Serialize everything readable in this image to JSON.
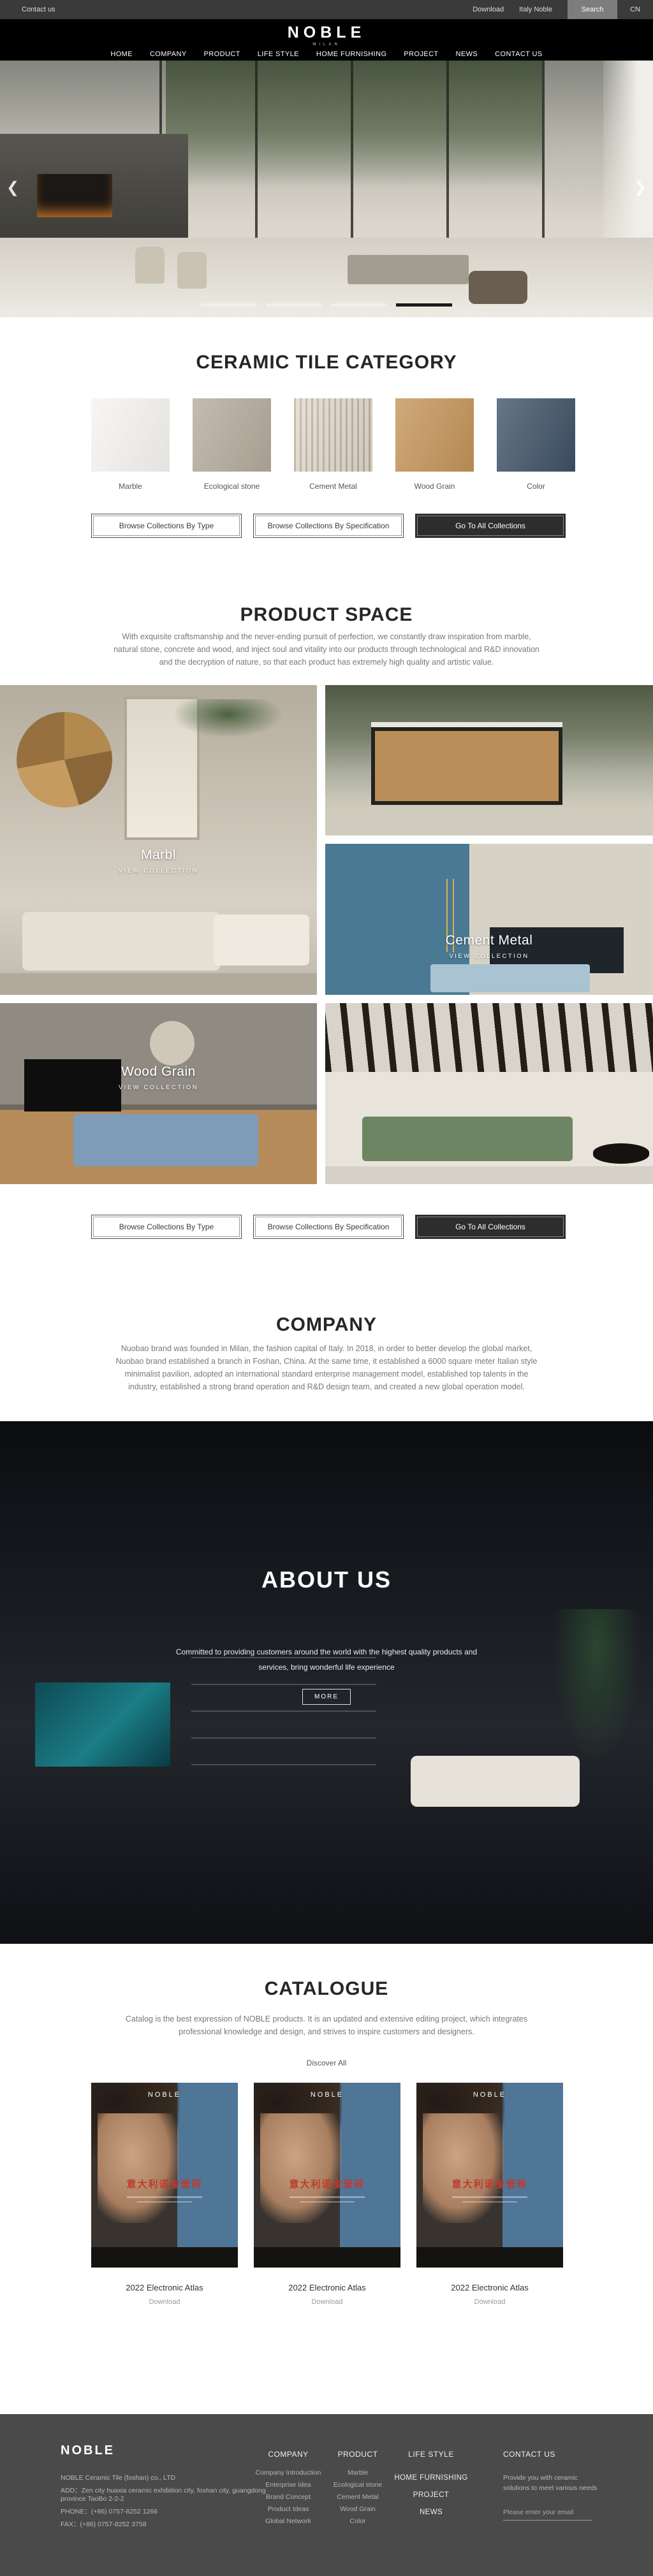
{
  "topbar": {
    "contact_us": "Contact us",
    "download": "Download",
    "italy_noble": "Italy Noble",
    "search": "Search",
    "language": "CN"
  },
  "header": {
    "logo": "NOBLE",
    "logo_subtitle": "MILAN",
    "nav": [
      "HOME",
      "COMPANY",
      "PRODUCT",
      "LIFE STYLE",
      "HOME FURNISHING",
      "PROJECT",
      "NEWS",
      "CONTACT US"
    ]
  },
  "hero": {
    "prev_arrow": "❮",
    "next_arrow": "❯",
    "indicators": {
      "count": 4,
      "active_index": 3,
      "inactive_color": "#f2f0ec",
      "active_color": "#1a1a1a"
    }
  },
  "category": {
    "title": "CERAMIC TILE CATEGORY",
    "items": [
      {
        "label": "Marble",
        "color": "#f5f3f0"
      },
      {
        "label": "Ecological stone",
        "color": "#b3a99b"
      },
      {
        "label": "Cement Metal",
        "color": "#d8d4cc"
      },
      {
        "label": "Wood Grain",
        "color": "#c29257"
      },
      {
        "label": "Color",
        "color": "#3d5064"
      }
    ]
  },
  "actions": {
    "browse_type": "Browse Collections By Type",
    "browse_spec": "Browse Collections By Specification",
    "go_all": "Go To All Collections"
  },
  "space": {
    "title": "PRODUCT SPACE",
    "paragraph": [
      "With exquisite craftsmanship and the never-ending pursuit of perfection, we constantly draw inspiration from marble,",
      "natural stone, concrete and wood, and inject soul and vitality into our products through technological and R&D innovation",
      "and the decryption of nature, so that each product has extremely high quality and artistic value."
    ],
    "cards": {
      "marble": {
        "title": "Marbl",
        "cta": "VIEW COLLECTION"
      },
      "cement": {
        "title": "Cement Metal",
        "cta": "VIEW COLLECTION"
      },
      "wood": {
        "title": "Wood Grain",
        "cta": "VIEW COLLECTION"
      }
    }
  },
  "company": {
    "title": "COMPANY",
    "paragraph": [
      "Nuobao brand was founded in Milan, the fashion capital of Italy. In 2018, in order to better develop the global market,",
      "Nuobao brand established a branch in Foshan, China. At the same time, it established a 6000 square meter Italian style",
      "minimalist pavilion, adopted an international standard enterprise management model, established top talents in the",
      "industry, established a strong brand operation and R&D design team, and created a new global operation model."
    ]
  },
  "about": {
    "title": "ABOUT US",
    "paragraph": [
      "Committed to providing customers around the world with the highest quality products and",
      "services, bring wonderful life experience"
    ],
    "more_label": "MORE"
  },
  "catalogue": {
    "title": "CATALOGUE",
    "paragraph": [
      "Catalog is the best expression of NOBLE products. It is an updated and extensive editing project, which integrates",
      "professional knowledge and design, and strives to inspire customers and designers."
    ],
    "discover_all": "Discover All",
    "poster": {
      "brand": "NOBLE",
      "headline": "意大利诺宝瓷砖",
      "headline_color": "#c03a2e",
      "panel_color": "#4f7597"
    },
    "items": [
      {
        "name": "2022 Electronic Atlas",
        "download": "Download"
      },
      {
        "name": "2022 Electronic Atlas",
        "download": "Download"
      },
      {
        "name": "2022 Electronic Atlas",
        "download": "Download"
      }
    ]
  },
  "footer": {
    "brand": "NOBLE",
    "info": [
      "NOBLE Ceramic Tile (foshan) co., LTD",
      "ADD：Zen city huaxia ceramic exhibition city, foshan city, guangdong province TaoBo 2-2-2",
      "PHONE：(+86) 0757-8252 1266",
      "FAX：(+86) 0757-8252 3758"
    ],
    "columns": [
      {
        "title": "COMPANY",
        "links": [
          "Company Introduction",
          "Enterprise Idea",
          "Brand Concept",
          "Product Ideas",
          "Global Network"
        ]
      },
      {
        "title": "PRODUCT",
        "links": [
          "Marble",
          "Ecological stone",
          "Cement Metal",
          "Wood Grain",
          "Color"
        ]
      }
    ],
    "nav_title": "LIFE STYLE",
    "nav_links": [
      "HOME FURNISHING",
      "PROJECT",
      "NEWS"
    ],
    "contact": {
      "title": "CONTACT US",
      "text": "Provide you with ceramic solutions to meet various needs",
      "email_placeholder": "Please enter your email"
    }
  }
}
